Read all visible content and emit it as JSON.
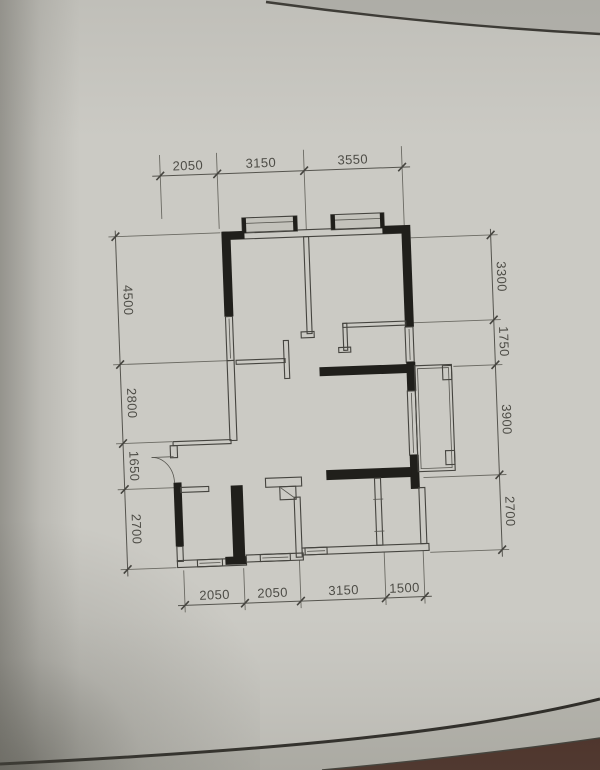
{
  "document": {
    "kind": "apartment-floor-plan-photo",
    "colors": {
      "paper": "#cbcac4",
      "paper_shadow": "#a3a29b",
      "under_sheet": "#b9b8b1",
      "table": "#45271e",
      "wall_black": "#201f1b",
      "wall_line": "#45443f",
      "dim_text": "#4e4d47"
    }
  },
  "floor_plan": {
    "dimensions_mm": {
      "top": [
        "2050",
        "3150",
        "3550"
      ],
      "bottom": [
        "2050",
        "2050",
        "3150",
        "1500"
      ],
      "left": [
        "4500",
        "2800",
        "1650",
        "2700"
      ],
      "right": [
        "3300",
        "1750",
        "3900",
        "2700"
      ]
    }
  }
}
